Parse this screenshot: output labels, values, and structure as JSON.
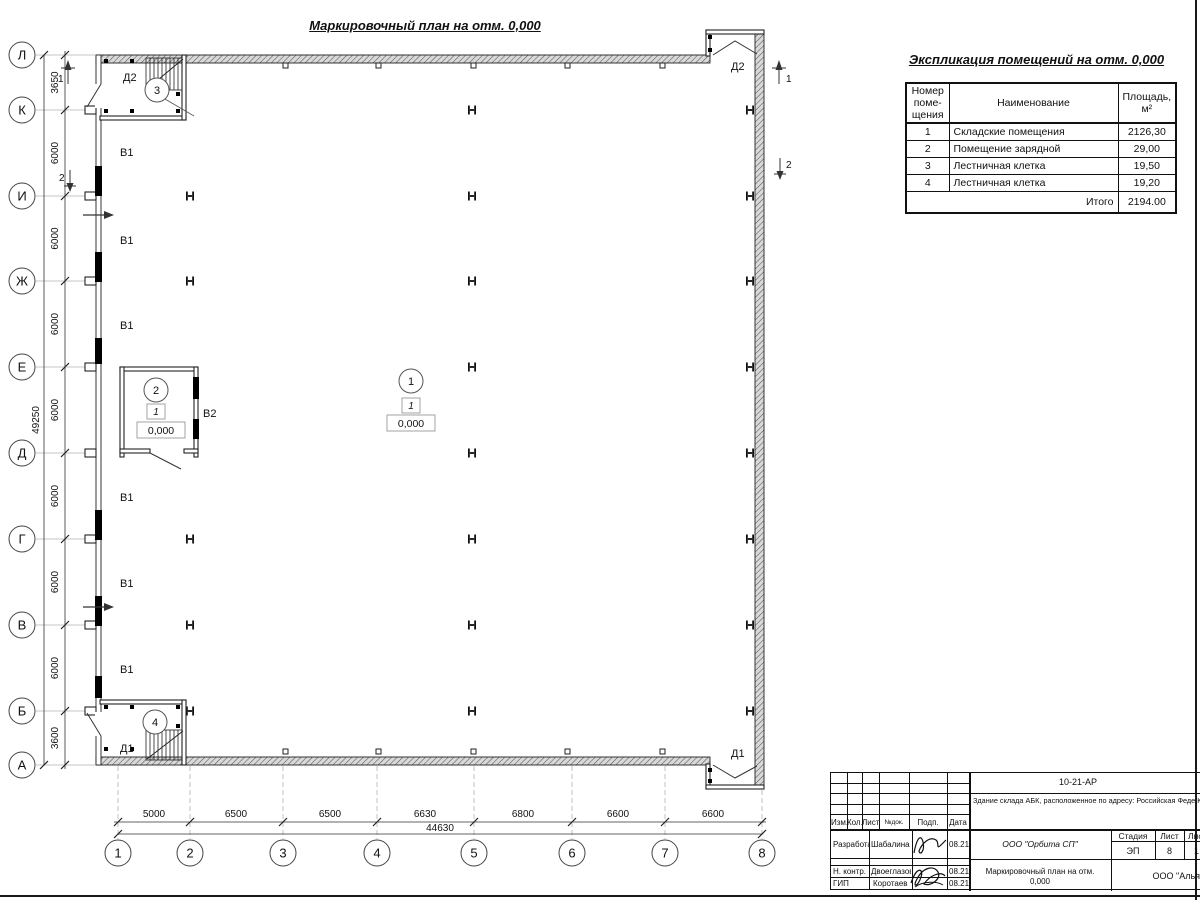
{
  "sheet": {
    "plan_title": "Маркировочный план на отм. 0,000"
  },
  "plan": {
    "row_axes": [
      {
        "label": "Л"
      },
      {
        "label": "К"
      },
      {
        "label": "И"
      },
      {
        "label": "Ж"
      },
      {
        "label": "Е"
      },
      {
        "label": "Д"
      },
      {
        "label": "Г"
      },
      {
        "label": "В"
      },
      {
        "label": "Б"
      },
      {
        "label": "А"
      }
    ],
    "col_axes": [
      {
        "label": "1"
      },
      {
        "label": "2"
      },
      {
        "label": "3"
      },
      {
        "label": "4"
      },
      {
        "label": "5"
      },
      {
        "label": "6"
      },
      {
        "label": "7"
      },
      {
        "label": "8"
      }
    ],
    "row_dims": [
      {
        "value": "3650"
      },
      {
        "value": "6000"
      },
      {
        "value": "6000"
      },
      {
        "value": "6000"
      },
      {
        "value": "6000"
      },
      {
        "value": "6000"
      },
      {
        "value": "6000"
      },
      {
        "value": "6000"
      },
      {
        "value": "3600"
      }
    ],
    "row_total": "49250",
    "col_dims": [
      {
        "value": "5000"
      },
      {
        "value": "6500"
      },
      {
        "value": "6500"
      },
      {
        "value": "6630"
      },
      {
        "value": "6800"
      },
      {
        "value": "6600"
      },
      {
        "value": "6600"
      }
    ],
    "col_total": "44630",
    "markers": {
      "room1": "1",
      "room2": "2",
      "room3": "3",
      "room4": "4",
      "floor_type": "1",
      "elevation": "0,000"
    },
    "door_labels": {
      "d1": "Д1",
      "d2": "Д2"
    },
    "window_labels": {
      "v1": "В1",
      "v2": "В2"
    },
    "sections": {
      "s1": "1",
      "s2": "2"
    }
  },
  "schedule": {
    "title": "Экспликация помещений на отм. 0,000",
    "col_number": "Номер\nпоме-\nщения",
    "col_name": "Наименование",
    "col_area": "Площадь,\nм²",
    "rows": [
      {
        "num": "1",
        "name": "Складские помещения",
        "area": "2126,30"
      },
      {
        "num": "2",
        "name": "Помещение зарядной",
        "area": "29,00"
      },
      {
        "num": "3",
        "name": "Лестничная клетка",
        "area": "19,50"
      },
      {
        "num": "4",
        "name": "Лестничная клетка",
        "area": "19,20"
      }
    ],
    "total_label": "Итого",
    "total_value": "2194.00"
  },
  "titleblock": {
    "doc_number": "10-21-АР",
    "description": "Здание склада АБК, расположенное по адресу: Российская Феде\nКировская область, г. Кирово-Чепецк, ул. Заводская, площадка з\nполимеров (кадастровый номер земельного участка 43:42:00000",
    "header_cols": {
      "izm": "Изм.",
      "kol": "Кол.",
      "list": "Лист",
      "ndoc": "№док.",
      "podp": "Подп.",
      "data": "Дата"
    },
    "rows": [
      {
        "role": "Разработал",
        "name": "Шабалина",
        "date": "08.21"
      },
      {
        "role": "Н. контр.",
        "name": "Двоеглазов",
        "date": "08.21"
      },
      {
        "role": "ГИП",
        "name": "Коротаев",
        "date": "08.21"
      }
    ],
    "company": "ООО \"Орбита СП\"",
    "stage_label": "Стадия",
    "sheet_label": "Лист",
    "sheets_label": "Листов",
    "stage": "ЭП",
    "sheet": "8",
    "sheets": "1",
    "drawing_title": "Маркировочный план на отм.\n0,000",
    "bottom_company": "ООО \"Альянс"
  }
}
